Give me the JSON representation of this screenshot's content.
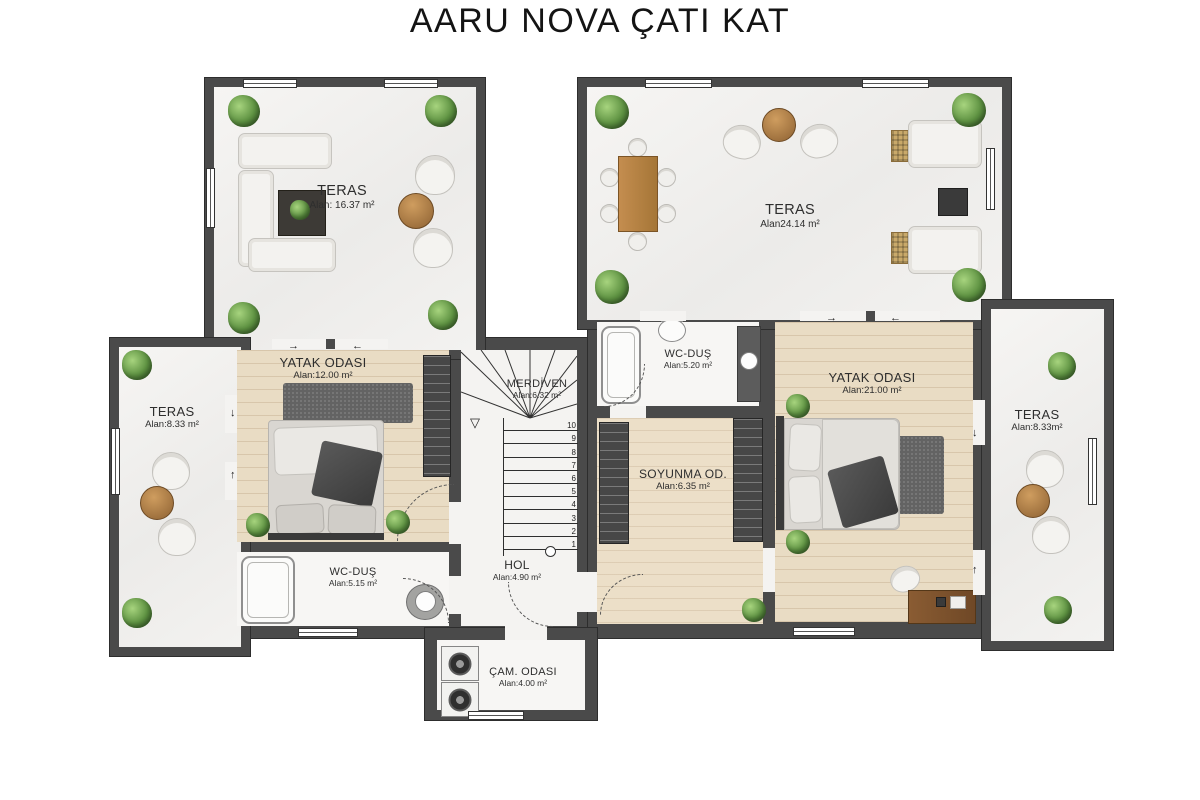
{
  "title": "AARU NOVA ÇATI KAT",
  "rooms": {
    "teras_top_left": {
      "name": "TERAS",
      "area": "Alan: 16.37 m²"
    },
    "teras_top_right": {
      "name": "TERAS",
      "area": "Alan24.14 m²"
    },
    "teras_left": {
      "name": "TERAS",
      "area": "Alan:8.33 m²"
    },
    "teras_right": {
      "name": "TERAS",
      "area": "Alan:8.33m²"
    },
    "bedroom_left": {
      "name": "YATAK ODASI",
      "area": "Alan:12.00 m²"
    },
    "stairs": {
      "name": "MERDİVEN",
      "area": "Alan:6.32 m²"
    },
    "wc_top": {
      "name": "WC-DUŞ",
      "area": "Alan:5.20 m²"
    },
    "bedroom_right": {
      "name": "YATAK ODASI",
      "area": "Alan:21.00 m²"
    },
    "dressing": {
      "name": "SOYUNMA OD.",
      "area": "Alan:6.35 m²"
    },
    "wc_bottom": {
      "name": "WC-DUŞ",
      "area": "Alan:5.15 m²"
    },
    "hall": {
      "name": "HOL",
      "area": "Alan:4.90 m²"
    },
    "laundry": {
      "name": "ÇAM. ODASI",
      "area": "Alan:4.00 m²"
    }
  },
  "stair_steps": [
    "10",
    "9",
    "8",
    "7",
    "6",
    "5",
    "4",
    "3",
    "2",
    "1"
  ],
  "icons": {
    "arrow_right": "→",
    "arrow_left": "←",
    "arrow_up": "↑",
    "arrow_down": "↓",
    "arrow_landing": "▽"
  },
  "colors": {
    "wall": "#4a4a4a",
    "wood_floor": "#e9dcc4",
    "terrace_floor": "#f4f3f1",
    "tile_floor": "#f7f6f4",
    "plant_green": "#5d9141",
    "wood_table": "#b9834e",
    "rug_gray": "#636363"
  }
}
